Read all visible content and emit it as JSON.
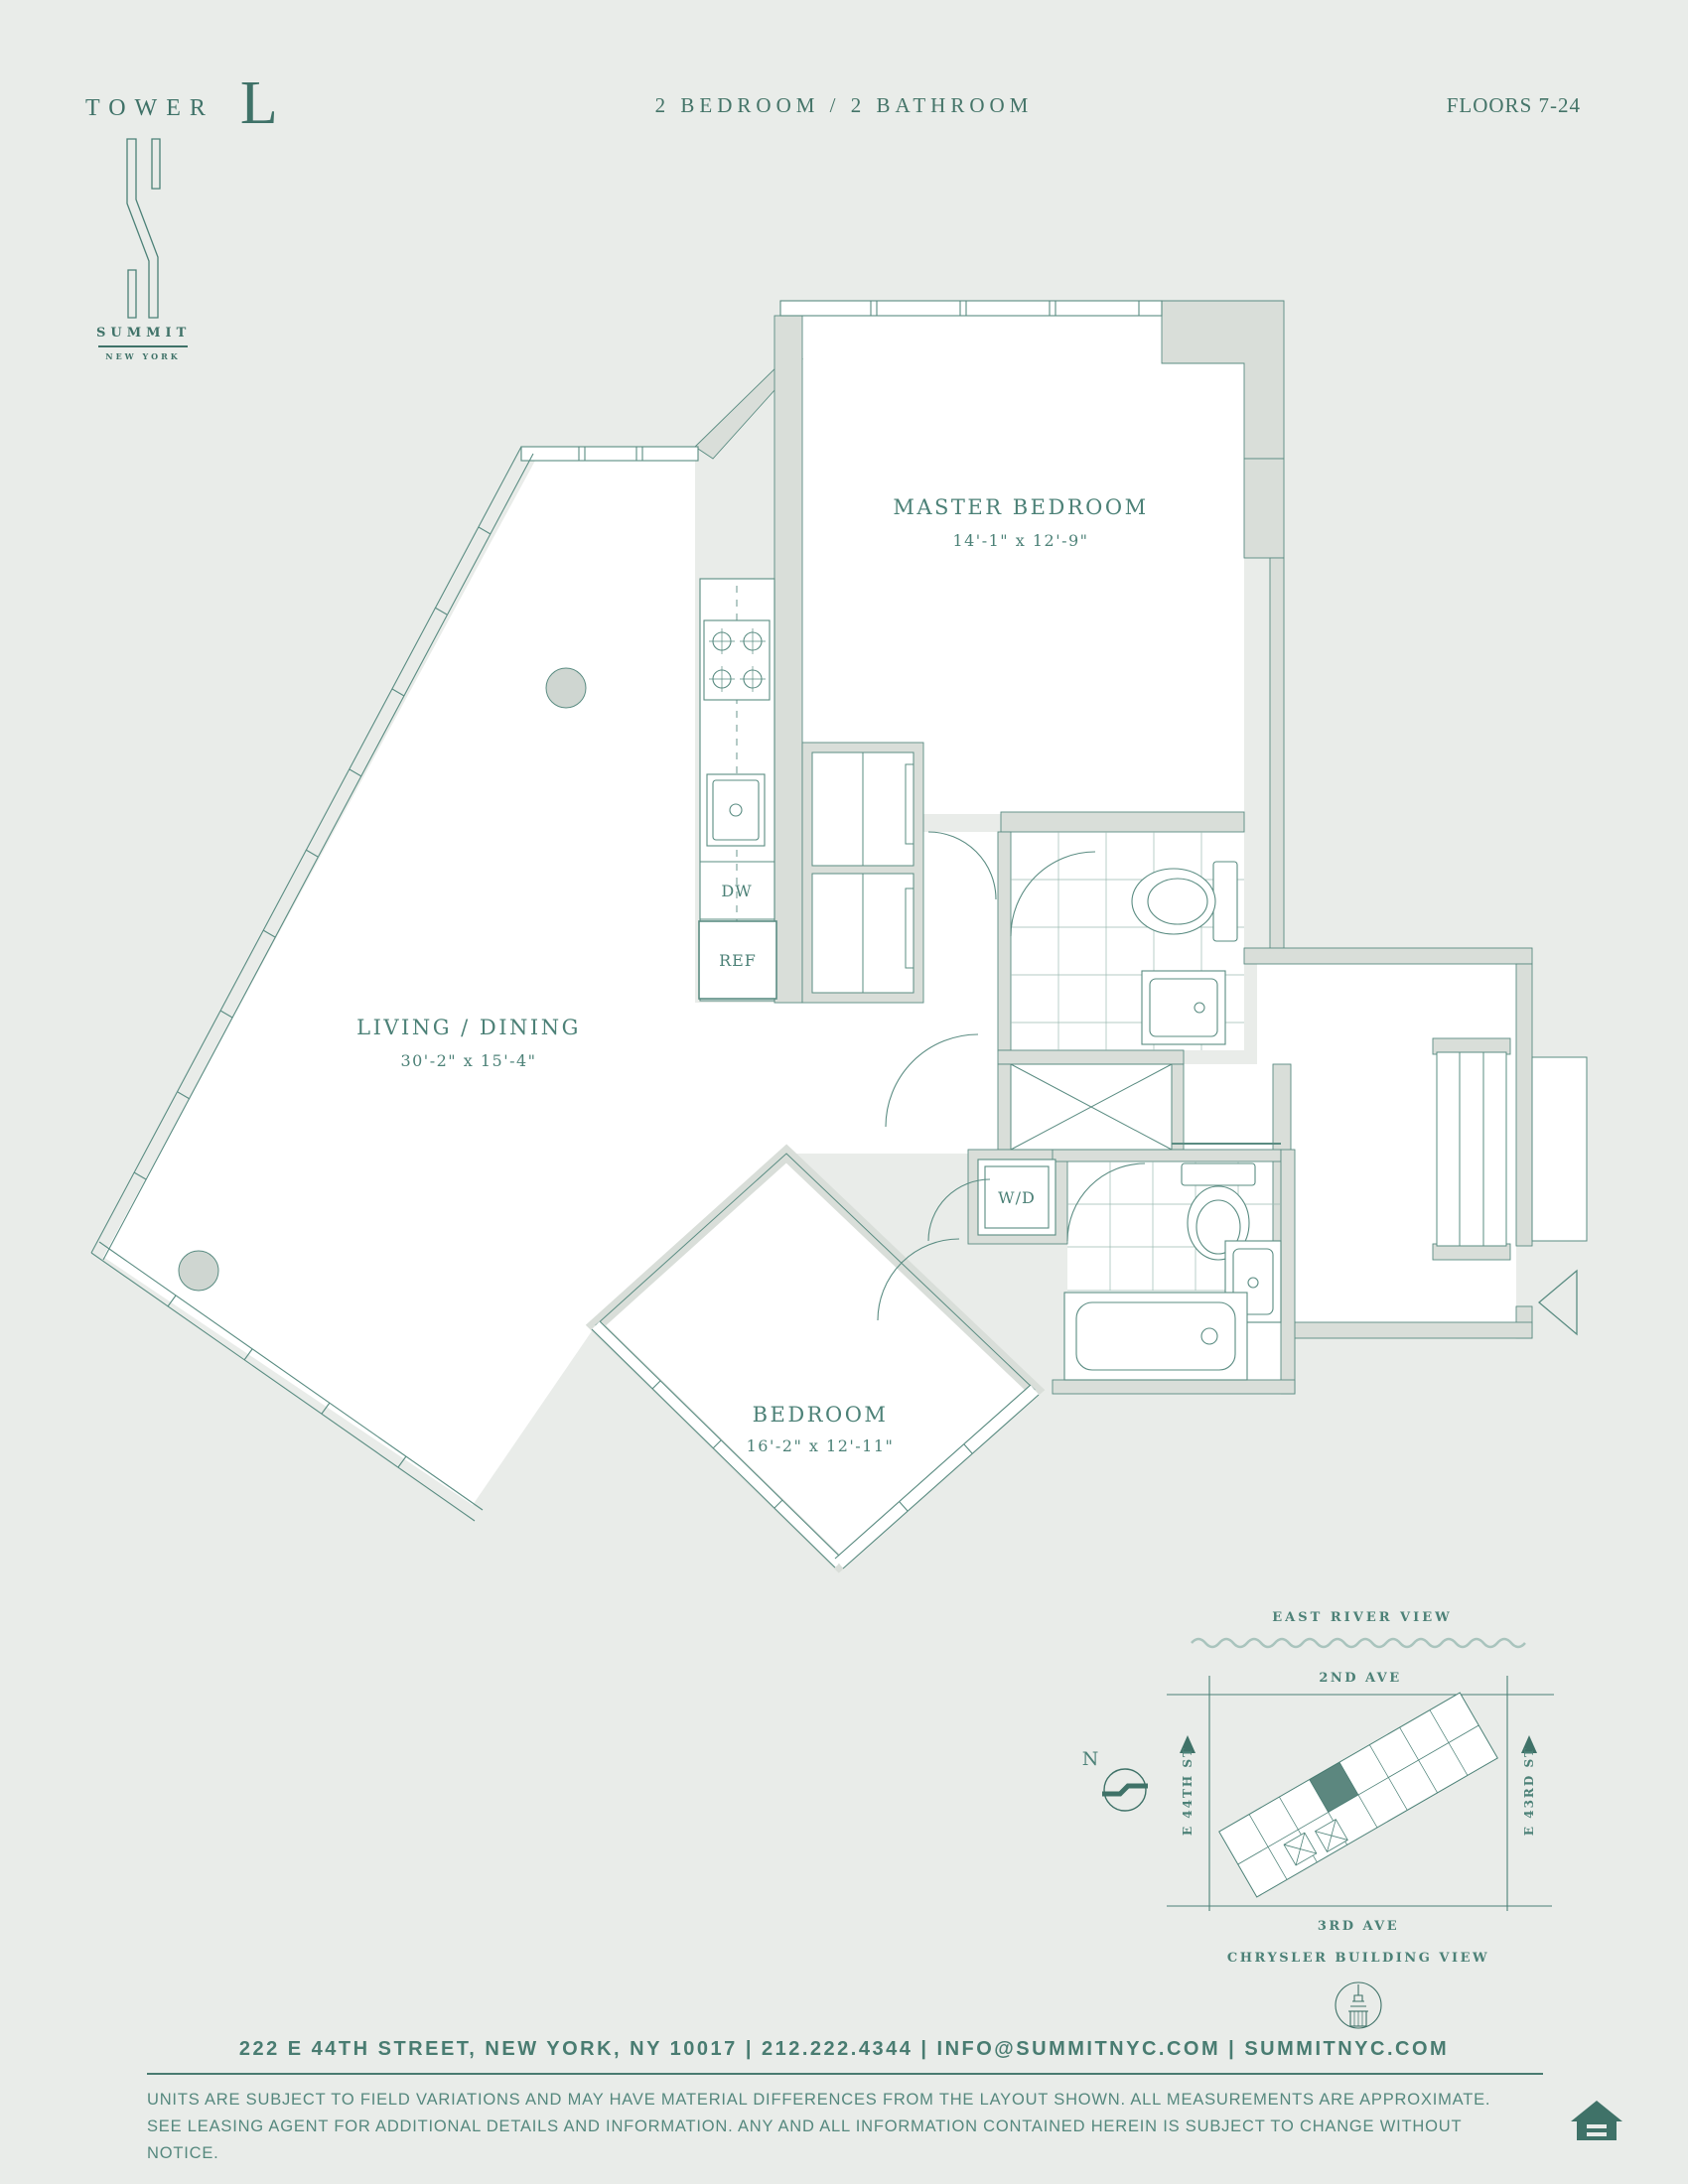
{
  "header": {
    "tower_label": "TOWER",
    "tower_letter": "L",
    "unit_type": "2 BEDROOM / 2 BATHROOM",
    "floors": "FLOORS 7-24"
  },
  "logo": {
    "name": "SUMMIT",
    "location": "NEW YORK"
  },
  "plan": {
    "rooms": {
      "master_bedroom": {
        "name": "MASTER BEDROOM",
        "dims": "14'-1\" x 12'-9\""
      },
      "living_dining": {
        "name": "LIVING / DINING",
        "dims": "30'-2\" x 15'-4\""
      },
      "bedroom": {
        "name": "BEDROOM",
        "dims": "16'-2\" x 12'-11\""
      }
    },
    "appliances": {
      "dishwasher": "DW",
      "refrigerator": "REF",
      "washer_dryer": "W/D"
    }
  },
  "site_map": {
    "top_view": "EAST RIVER VIEW",
    "top_street": "2ND AVE",
    "left_street": "E 44TH ST",
    "right_street": "E 43RD ST",
    "bottom_street": "3RD AVE",
    "bottom_view": "CHRYSLER BUILDING VIEW",
    "compass": "N"
  },
  "footer": {
    "contact": "222 E 44TH STREET, NEW YORK, NY 10017 | 212.222.4344 | INFO@SUMMITNYC.COM | SUMMITNYC.COM",
    "disclaimer_line1": "UNITS ARE SUBJECT TO FIELD VARIATIONS AND MAY HAVE MATERIAL DIFFERENCES FROM THE LAYOUT SHOWN. ALL MEASUREMENTS ARE APPROXIMATE.",
    "disclaimer_line2": "SEE LEASING AGENT FOR ADDITIONAL DETAILS AND INFORMATION. ANY AND ALL INFORMATION CONTAINED HEREIN IS SUBJECT TO CHANGE WITHOUT NOTICE."
  },
  "colors": {
    "background": "#e9ece9",
    "wall": "#d9ded9",
    "line": "#5a8c82",
    "text": "#3f7268"
  }
}
